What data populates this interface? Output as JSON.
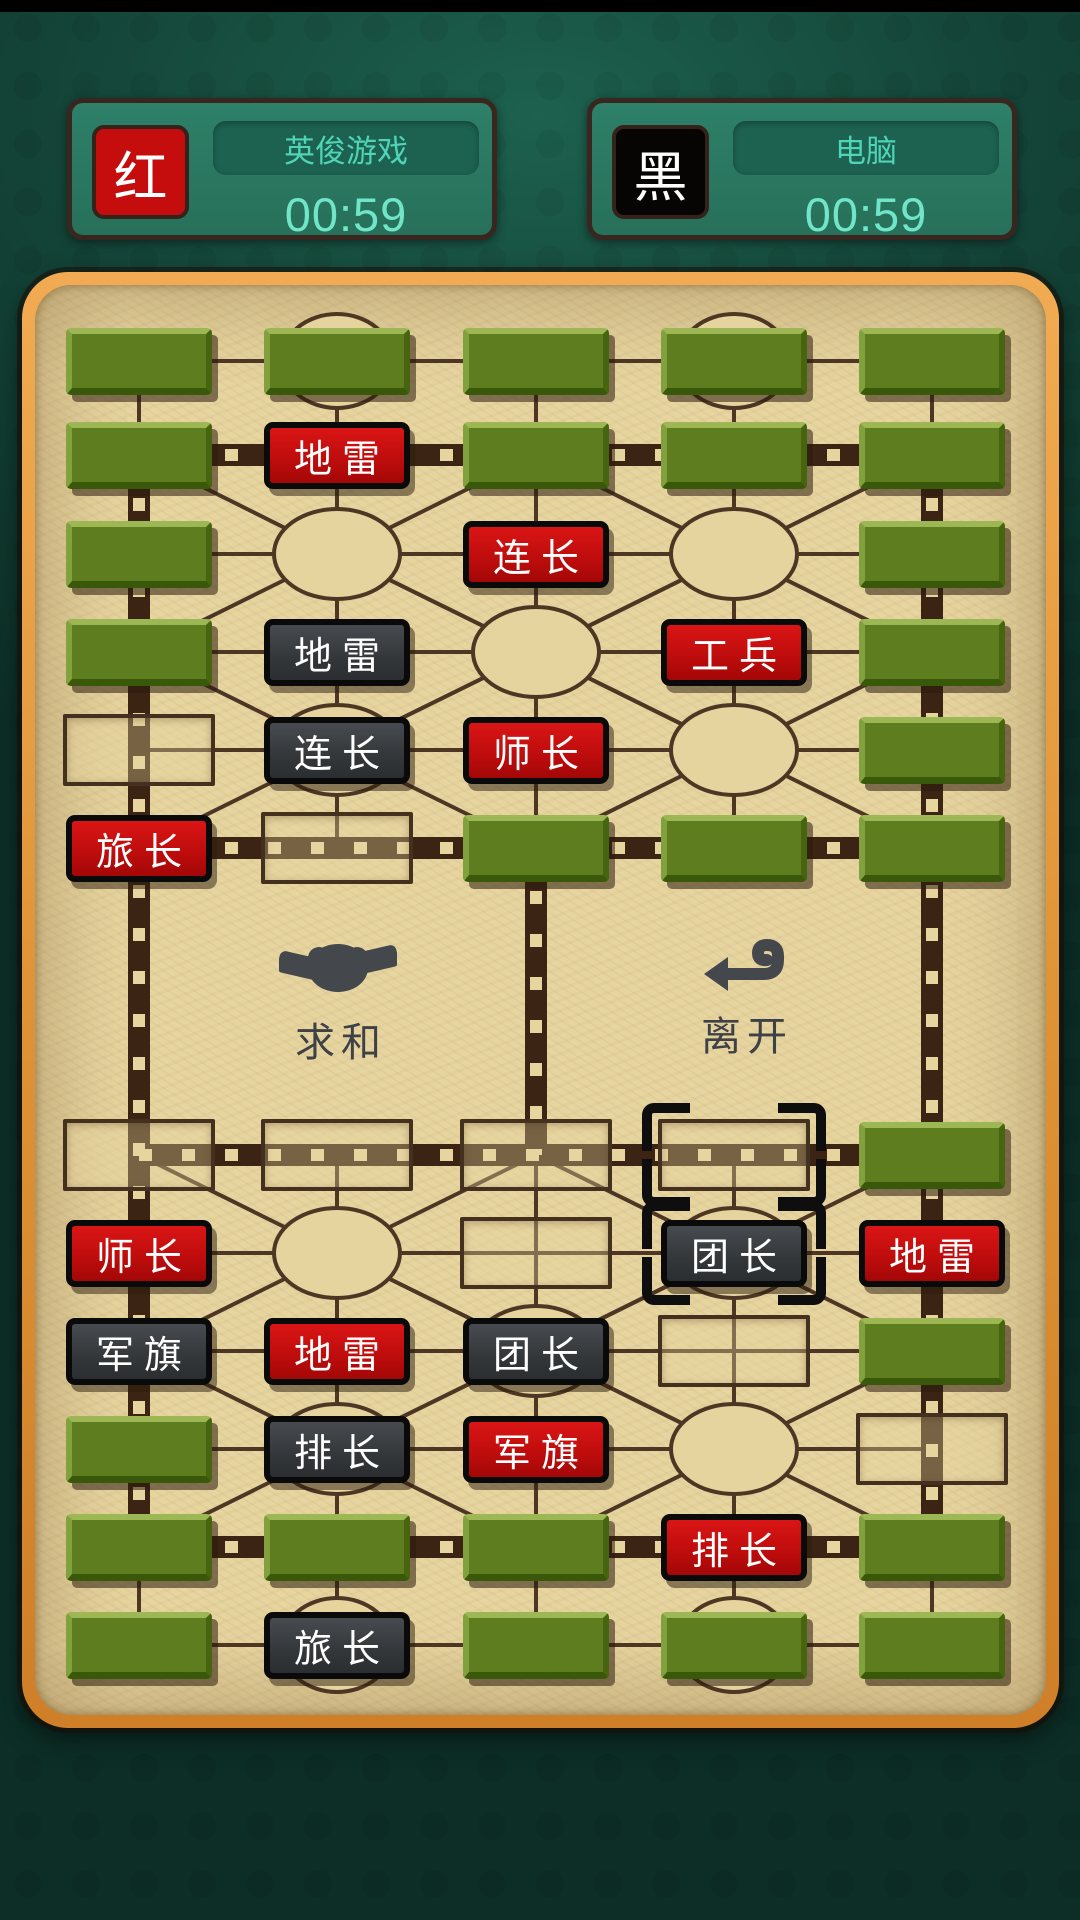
{
  "players": [
    {
      "side": "red",
      "side_label": "红",
      "name": "英俊游戏",
      "timer": "00:59"
    },
    {
      "side": "black",
      "side_label": "黑",
      "name": "电脑",
      "timer": "00:59"
    }
  ],
  "board": {
    "columns": 5,
    "rows": 12,
    "buttons": [
      {
        "label": "求和",
        "icon": "handshake-icon"
      },
      {
        "label": "离开",
        "icon": "leave-arrow-icon"
      }
    ],
    "camps": [
      [
        3,
        2
      ],
      [
        3,
        4
      ],
      [
        4,
        3
      ],
      [
        5,
        2
      ],
      [
        5,
        4
      ],
      [
        8,
        2
      ],
      [
        8,
        4
      ],
      [
        9,
        3
      ],
      [
        10,
        2
      ],
      [
        10,
        4
      ]
    ],
    "headquarters": [
      [
        1,
        2
      ],
      [
        1,
        4
      ],
      [
        12,
        2
      ],
      [
        12,
        4
      ]
    ],
    "pieces": [
      {
        "r": 1,
        "c": 1,
        "kind": "hidden",
        "label": "",
        "name": "hidden"
      },
      {
        "r": 1,
        "c": 2,
        "kind": "hidden",
        "label": "",
        "name": "hidden"
      },
      {
        "r": 1,
        "c": 3,
        "kind": "hidden",
        "label": "",
        "name": "hidden"
      },
      {
        "r": 1,
        "c": 4,
        "kind": "hidden",
        "label": "",
        "name": "hidden"
      },
      {
        "r": 1,
        "c": 5,
        "kind": "hidden",
        "label": "",
        "name": "hidden"
      },
      {
        "r": 2,
        "c": 1,
        "kind": "hidden",
        "label": "",
        "name": "hidden"
      },
      {
        "r": 2,
        "c": 2,
        "kind": "red",
        "label": "地雷",
        "name": "landmine"
      },
      {
        "r": 2,
        "c": 3,
        "kind": "hidden",
        "label": "",
        "name": "hidden"
      },
      {
        "r": 2,
        "c": 4,
        "kind": "hidden",
        "label": "",
        "name": "hidden"
      },
      {
        "r": 2,
        "c": 5,
        "kind": "hidden",
        "label": "",
        "name": "hidden"
      },
      {
        "r": 3,
        "c": 1,
        "kind": "hidden",
        "label": "",
        "name": "hidden"
      },
      {
        "r": 3,
        "c": 3,
        "kind": "red",
        "label": "连长",
        "name": "company-commander"
      },
      {
        "r": 3,
        "c": 5,
        "kind": "hidden",
        "label": "",
        "name": "hidden"
      },
      {
        "r": 4,
        "c": 1,
        "kind": "hidden",
        "label": "",
        "name": "hidden"
      },
      {
        "r": 4,
        "c": 2,
        "kind": "black",
        "label": "地雷",
        "name": "landmine"
      },
      {
        "r": 4,
        "c": 4,
        "kind": "red",
        "label": "工兵",
        "name": "engineer"
      },
      {
        "r": 4,
        "c": 5,
        "kind": "hidden",
        "label": "",
        "name": "hidden"
      },
      {
        "r": 5,
        "c": 1,
        "kind": "empty",
        "label": "",
        "name": "vacated-cell"
      },
      {
        "r": 5,
        "c": 2,
        "kind": "black",
        "label": "连长",
        "name": "company-commander"
      },
      {
        "r": 5,
        "c": 3,
        "kind": "red",
        "label": "师长",
        "name": "division-commander"
      },
      {
        "r": 5,
        "c": 5,
        "kind": "hidden",
        "label": "",
        "name": "hidden"
      },
      {
        "r": 6,
        "c": 1,
        "kind": "red",
        "label": "旅长",
        "name": "brigade-commander"
      },
      {
        "r": 6,
        "c": 2,
        "kind": "empty",
        "label": "",
        "name": "vacated-cell"
      },
      {
        "r": 6,
        "c": 3,
        "kind": "hidden",
        "label": "",
        "name": "hidden"
      },
      {
        "r": 6,
        "c": 4,
        "kind": "hidden",
        "label": "",
        "name": "hidden"
      },
      {
        "r": 6,
        "c": 5,
        "kind": "hidden",
        "label": "",
        "name": "hidden"
      },
      {
        "r": 7,
        "c": 1,
        "kind": "empty",
        "label": "",
        "name": "vacated-cell"
      },
      {
        "r": 7,
        "c": 2,
        "kind": "empty",
        "label": "",
        "name": "vacated-cell"
      },
      {
        "r": 7,
        "c": 3,
        "kind": "empty",
        "label": "",
        "name": "vacated-cell"
      },
      {
        "r": 7,
        "c": 4,
        "kind": "empty",
        "label": "",
        "name": "vacated-cell",
        "selected": true
      },
      {
        "r": 7,
        "c": 5,
        "kind": "hidden",
        "label": "",
        "name": "hidden"
      },
      {
        "r": 8,
        "c": 1,
        "kind": "red",
        "label": "师长",
        "name": "division-commander"
      },
      {
        "r": 8,
        "c": 3,
        "kind": "empty",
        "label": "",
        "name": "vacated-cell"
      },
      {
        "r": 8,
        "c": 4,
        "kind": "black",
        "label": "团长",
        "name": "regiment-commander",
        "selected": true
      },
      {
        "r": 8,
        "c": 5,
        "kind": "red",
        "label": "地雷",
        "name": "landmine"
      },
      {
        "r": 9,
        "c": 1,
        "kind": "black",
        "label": "军旗",
        "name": "army-flag"
      },
      {
        "r": 9,
        "c": 2,
        "kind": "red",
        "label": "地雷",
        "name": "landmine"
      },
      {
        "r": 9,
        "c": 3,
        "kind": "black",
        "label": "团长",
        "name": "regiment-commander"
      },
      {
        "r": 9,
        "c": 4,
        "kind": "empty",
        "label": "",
        "name": "vacated-cell"
      },
      {
        "r": 9,
        "c": 5,
        "kind": "hidden",
        "label": "",
        "name": "hidden"
      },
      {
        "r": 10,
        "c": 1,
        "kind": "hidden",
        "label": "",
        "name": "hidden"
      },
      {
        "r": 10,
        "c": 2,
        "kind": "black",
        "label": "排长",
        "name": "platoon-commander"
      },
      {
        "r": 10,
        "c": 3,
        "kind": "red",
        "label": "军旗",
        "name": "army-flag"
      },
      {
        "r": 10,
        "c": 5,
        "kind": "empty",
        "label": "",
        "name": "vacated-cell"
      },
      {
        "r": 11,
        "c": 1,
        "kind": "hidden",
        "label": "",
        "name": "hidden"
      },
      {
        "r": 11,
        "c": 2,
        "kind": "hidden",
        "label": "",
        "name": "hidden"
      },
      {
        "r": 11,
        "c": 3,
        "kind": "hidden",
        "label": "",
        "name": "hidden"
      },
      {
        "r": 11,
        "c": 4,
        "kind": "red",
        "label": "排长",
        "name": "platoon-commander"
      },
      {
        "r": 11,
        "c": 5,
        "kind": "hidden",
        "label": "",
        "name": "hidden"
      },
      {
        "r": 12,
        "c": 1,
        "kind": "hidden",
        "label": "",
        "name": "hidden"
      },
      {
        "r": 12,
        "c": 2,
        "kind": "black",
        "label": "旅长",
        "name": "brigade-commander"
      },
      {
        "r": 12,
        "c": 3,
        "kind": "hidden",
        "label": "",
        "name": "hidden"
      },
      {
        "r": 12,
        "c": 4,
        "kind": "hidden",
        "label": "",
        "name": "hidden"
      },
      {
        "r": 12,
        "c": 5,
        "kind": "hidden",
        "label": "",
        "name": "hidden"
      }
    ]
  },
  "colors": {
    "background_teal": "#134236",
    "board_tan": "#e7d5a0",
    "frame_orange": "#e09a42",
    "red_piece": "#c50d0d",
    "black_piece": "#34373a",
    "hidden_piece_green": "#5e7d1f",
    "road_brown": "#4d3724",
    "railway_brown": "#3b2413",
    "teal_text": "#4fd4b6"
  }
}
